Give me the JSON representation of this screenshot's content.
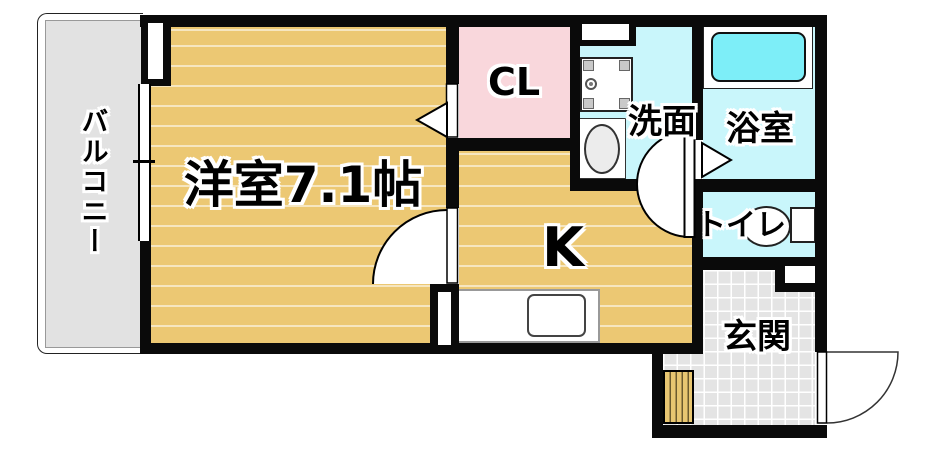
{
  "rooms": {
    "balcony": {
      "label": "バルコニー"
    },
    "western_room": {
      "label": "洋室7.1帖"
    },
    "closet": {
      "label": "CL"
    },
    "kitchen": {
      "label": "K"
    },
    "washroom": {
      "label": "洗面"
    },
    "bathroom": {
      "label": "浴室"
    },
    "toilet": {
      "label": "トイレ"
    },
    "entrance": {
      "label": "玄関"
    }
  },
  "colors": {
    "wall": "#0a0a0a",
    "floor": "#ecc873",
    "closet_pink": "#f9d7dc",
    "wet_area_cyan": "#c9f6fb",
    "bathtub_cyan": "#7deef8",
    "balcony_gray": "#e2e2e2",
    "entrance_tile": "#e4e4e4",
    "step_wood": "#e8c671"
  }
}
